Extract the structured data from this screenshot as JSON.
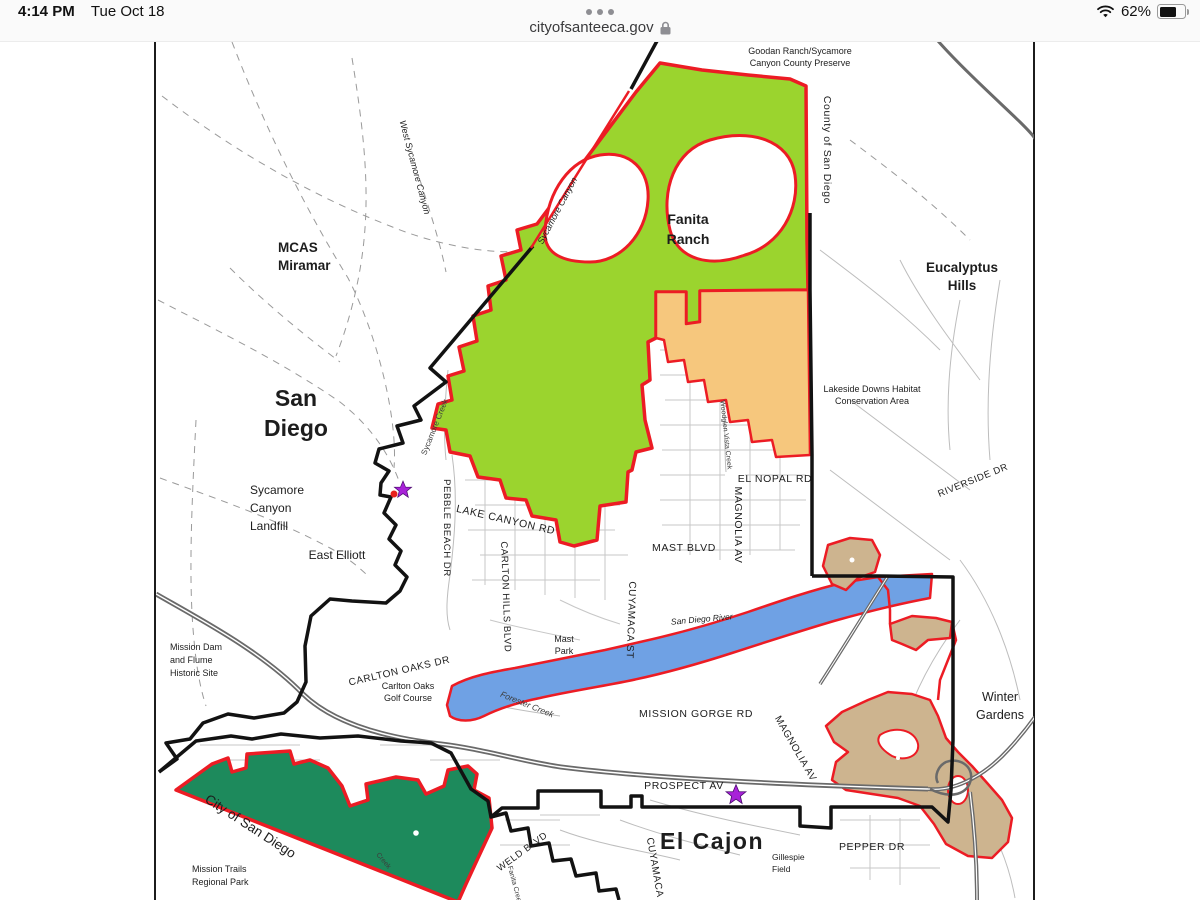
{
  "browser": {
    "status_bar": {
      "time": "4:14 PM",
      "date": "Tue Oct 18",
      "battery_percent": "62%"
    },
    "address_bar": {
      "url": "cityofsanteeca.gov"
    }
  },
  "map": {
    "colors": {
      "habitat_green": "#9bd42e",
      "preserve_orange": "#f6c77d",
      "river_blue": "#6fa1e4",
      "habitat_tan": "#cdb48f",
      "park_green": "#1d8a5c",
      "boundary_red": "#ec1c24",
      "city_boundary_black": "#121212",
      "star_purple": "#a822d8",
      "marker_red": "#e8211d"
    },
    "labels": {
      "goodan_1": "Goodan Ranch/Sycamore",
      "goodan_2": "Canyon County Preserve",
      "county_san_diego": "County of San Diego",
      "fanita_1": "Fanita",
      "fanita_2": "Ranch",
      "eucalyptus_1": "Eucalyptus",
      "eucalyptus_2": "Hills",
      "mcas_1": "MCAS",
      "mcas_2": "Miramar",
      "west_sycamore": "West Sycamore Canyon",
      "sycamore_canyon": "Sycamore Canyon",
      "san_diego_1": "San",
      "san_diego_2": "Diego",
      "landfill_1": "Sycamore",
      "landfill_2": "Canyon",
      "landfill_3": "Landfill",
      "east_elliott": "East Elliott",
      "sycamore_creek": "Sycamore Creek",
      "pebble_beach": "PEBBLE BEACH DR",
      "lake_canyon": "LAKE CANYON RD",
      "carlton_hills": "CARLTON HILLS BLVD",
      "mast_blvd": "MAST BLVD",
      "el_nopal": "EL NOPAL RD",
      "magnolia_north": "MAGNOLIA AV",
      "woodglen": "Woodglen Vista Creek",
      "riverside": "RIVERSIDE DR",
      "lakeside_1": "Lakeside Downs Habitat",
      "lakeside_2": "Conservation Area",
      "mission_dam_1": "Mission Dam",
      "mission_dam_2": "and Flume",
      "mission_dam_3": "Historic Site",
      "carlton_oaks": "CARLTON OAKS DR",
      "golf_1": "Carlton Oaks",
      "golf_2": "Golf Course",
      "mast_park_1": "Mast",
      "mast_park_2": "Park",
      "cuyamaca_st": "CUYAMACA ST",
      "san_diego_river": "San Diego River",
      "forester_creek": "Forester Creek",
      "mission_gorge": "MISSION GORGE RD",
      "magnolia_south": "MAGNOLIA AV",
      "winter_1": "Winter",
      "winter_2": "Gardens",
      "city_of_san_diego": "City of San Diego",
      "mission_trails_1": "Mission Trails",
      "mission_trails_2": "Regional Park",
      "prospect": "PROSPECT AV",
      "el_cajon": "El Cajon",
      "gillespie_1": "Gillespie",
      "gillespie_2": "Field",
      "pepper": "PEPPER DR",
      "weld": "WELD BLVD",
      "cuyamaca_south": "CUYAMACA",
      "fanita_creek": "Fanita Creek",
      "park_creek": "Creek"
    }
  }
}
